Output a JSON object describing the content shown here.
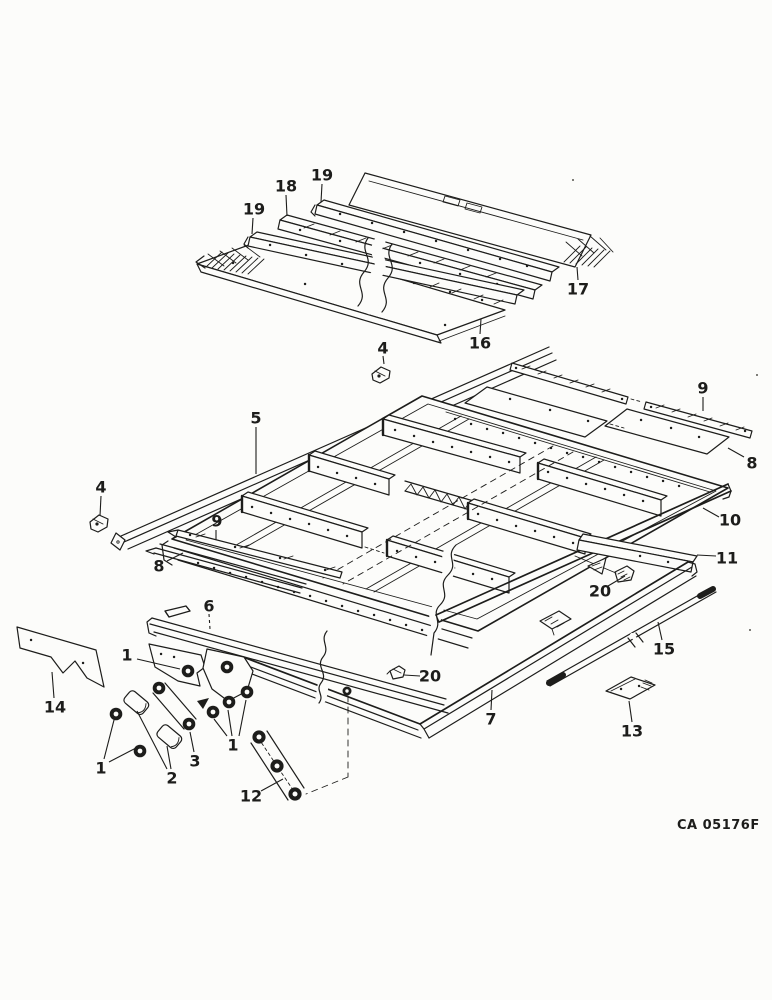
{
  "figure": {
    "code": "CA 05176F"
  },
  "style": {
    "ink": "#1d1d1b",
    "paper": "#fcfcfa"
  },
  "callouts": [
    {
      "label": "19",
      "x": 322,
      "y": 175,
      "leaders": [
        [
          [
            322,
            184
          ],
          [
            321,
            202
          ]
        ]
      ]
    },
    {
      "label": "18",
      "x": 286,
      "y": 186,
      "leaders": [
        [
          [
            286,
            195
          ],
          [
            287,
            216
          ]
        ]
      ]
    },
    {
      "label": "19",
      "x": 254,
      "y": 209,
      "leaders": [
        [
          [
            253,
            218
          ],
          [
            252,
            234
          ]
        ]
      ]
    },
    {
      "label": "17",
      "x": 578,
      "y": 289,
      "leaders": [
        [
          [
            578,
            280
          ],
          [
            577,
            267
          ]
        ]
      ]
    },
    {
      "label": "16",
      "x": 480,
      "y": 343,
      "leaders": [
        [
          [
            480,
            334
          ],
          [
            481,
            319
          ]
        ]
      ]
    },
    {
      "label": "4",
      "x": 383,
      "y": 348,
      "leaders": [
        [
          [
            383,
            356
          ],
          [
            384,
            364
          ]
        ]
      ]
    },
    {
      "label": "5",
      "x": 256,
      "y": 418,
      "leaders": [
        [
          [
            256,
            427
          ],
          [
            256,
            474
          ]
        ]
      ]
    },
    {
      "label": "4",
      "x": 101,
      "y": 487,
      "leaders": [
        [
          [
            101,
            496
          ],
          [
            100,
            516
          ]
        ]
      ]
    },
    {
      "label": "9",
      "x": 217,
      "y": 521,
      "leaders": [
        [
          [
            216,
            530
          ],
          [
            216,
            540
          ]
        ]
      ]
    },
    {
      "label": "8",
      "x": 159,
      "y": 566,
      "leaders": [
        [
          [
            167,
            561
          ],
          [
            183,
            553
          ]
        ]
      ]
    },
    {
      "label": "9",
      "x": 703,
      "y": 388,
      "leaders": [
        [
          [
            703,
            397
          ],
          [
            703,
            411
          ]
        ]
      ]
    },
    {
      "label": "8",
      "x": 752,
      "y": 463,
      "leaders": [
        [
          [
            744,
            457
          ],
          [
            728,
            448
          ]
        ]
      ]
    },
    {
      "label": "10",
      "x": 730,
      "y": 520,
      "leaders": [
        [
          [
            719,
            517
          ],
          [
            703,
            508
          ]
        ]
      ]
    },
    {
      "label": "11",
      "x": 727,
      "y": 558,
      "leaders": [
        [
          [
            716,
            556
          ],
          [
            697,
            555
          ]
        ]
      ]
    },
    {
      "label": "20",
      "x": 600,
      "y": 591,
      "leaders": [
        [
          [
            608,
            586
          ],
          [
            625,
            576
          ]
        ]
      ]
    },
    {
      "label": "20",
      "x": 430,
      "y": 676,
      "leaders": [
        [
          [
            420,
            676
          ],
          [
            404,
            675
          ]
        ]
      ]
    },
    {
      "label": "15",
      "x": 664,
      "y": 649,
      "leaders": [
        [
          [
            662,
            640
          ],
          [
            658,
            622
          ]
        ]
      ]
    },
    {
      "label": "13",
      "x": 632,
      "y": 731,
      "leaders": [
        [
          [
            632,
            722
          ],
          [
            629,
            701
          ]
        ]
      ]
    },
    {
      "label": "7",
      "x": 491,
      "y": 719,
      "leaders": [
        [
          [
            491,
            710
          ],
          [
            492,
            690
          ]
        ]
      ]
    },
    {
      "label": "6",
      "x": 209,
      "y": 606,
      "dashed": true,
      "leaders": [
        [
          [
            209,
            614
          ],
          [
            210,
            629
          ]
        ]
      ]
    },
    {
      "label": "14",
      "x": 55,
      "y": 707,
      "leaders": [
        [
          [
            54,
            698
          ],
          [
            52,
            672
          ]
        ]
      ]
    },
    {
      "label": "1",
      "x": 127,
      "y": 655,
      "leaders": [
        [
          [
            137,
            659
          ],
          [
            180,
            669
          ]
        ]
      ]
    },
    {
      "label": "1",
      "x": 101,
      "y": 768,
      "leaders": [
        [
          [
            104,
            759
          ],
          [
            114,
            720
          ]
        ],
        [
          [
            109,
            762
          ],
          [
            136,
            748
          ]
        ]
      ]
    },
    {
      "label": "2",
      "x": 172,
      "y": 778,
      "leaders": [
        [
          [
            167,
            769
          ],
          [
            137,
            711
          ]
        ],
        [
          [
            171,
            769
          ],
          [
            167,
            746
          ]
        ]
      ]
    },
    {
      "label": "3",
      "x": 195,
      "y": 761,
      "leaders": [
        [
          [
            194,
            752
          ],
          [
            190,
            732
          ]
        ]
      ]
    },
    {
      "label": "1",
      "x": 233,
      "y": 745,
      "leaders": [
        [
          [
            227,
            736
          ],
          [
            214,
            719
          ]
        ],
        [
          [
            232,
            736
          ],
          [
            228,
            710
          ]
        ],
        [
          [
            239,
            736
          ],
          [
            246,
            700
          ]
        ]
      ]
    },
    {
      "label": "12",
      "x": 251,
      "y": 796,
      "leaders": [
        [
          [
            261,
            791
          ],
          [
            283,
            779
          ]
        ]
      ]
    }
  ]
}
